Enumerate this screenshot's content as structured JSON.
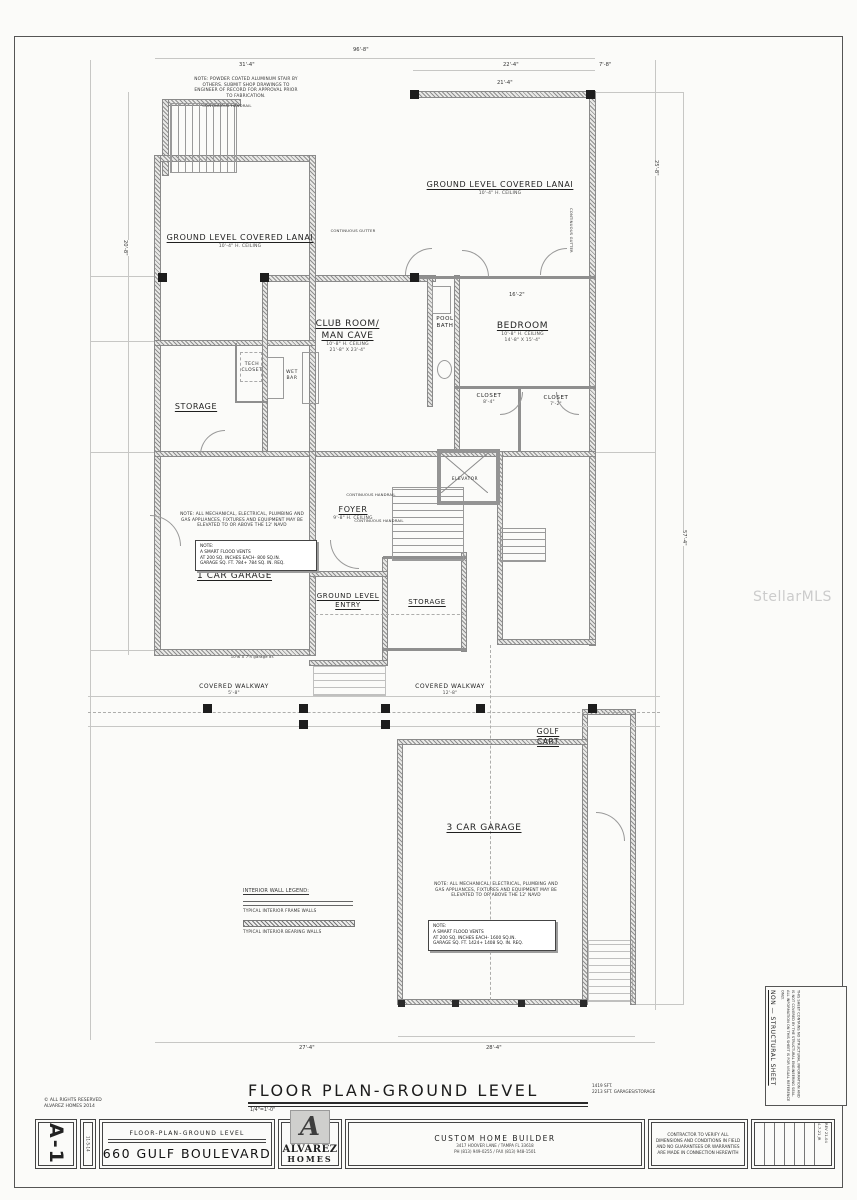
{
  "watermark": "StellarMLS",
  "plan_title": {
    "text": "FLOOR PLAN-GROUND LEVEL",
    "area1": "1419 SFT.",
    "area2": "2213 SFT. GARAGES/STORAGE",
    "scale": "1/4\"=1'-0\""
  },
  "copyright": {
    "line1": "© ALL RIGHTS RESERVED",
    "line2": "ALVAREZ HOMES 2014"
  },
  "side_note": {
    "title": "NON  —  STRUCTURAL  SHEET",
    "body": "THIS SHEET CONTAINS NO STRUCTURAL INFORMATION AND IS NOT COVERED BY THE STRUCTURAL ENGINEERING SEAL. ALL INFORMATION ON THIS SHEET IS FOR VISUAL REFERENCE ONLY."
  },
  "titleblock": {
    "sheet": "A-1",
    "date": "11-5-14",
    "sheet_title": "FLOOR-PLAN-GROUND LEVEL",
    "address": "660 GULF BOULEVARD",
    "logo_letter": "A",
    "brand_line1": "ALVAREZ",
    "brand_line2": "HOMES",
    "builder_title": "CUSTOM HOME BUILDER",
    "builder_line1": "3417 HOOVER LANE / TAMPA FL 33618",
    "builder_line2": "PH (813) 949-0255 / FAX (813) 948-1501",
    "disclaimer": "CONTRACTOR TO VERIFY ALL DIMENSIONS AND CONDITIONS IN FIELD AND NO GUARANTEES OR WARRANTIES ARE MADE IN CONNECTION HEREWITH",
    "rev1": "4-7-21 JR",
    "rev2": "REV 21-04"
  },
  "rooms": {
    "lanai_left": {
      "label": "GROUND LEVEL COVERED LANAI",
      "sub": "10'-4\" H. CEILING"
    },
    "lanai_right": {
      "label": "GROUND LEVEL COVERED LANAI",
      "sub": "10'-4\" H. CEILING"
    },
    "club": {
      "label": "CLUB ROOM/",
      "label2": "MAN CAVE",
      "sub1": "10'-8\" H. CEILING",
      "sub2": "21'-8\" X 23'-4\""
    },
    "pool_bath": {
      "label": "POOL",
      "label2": "BATH"
    },
    "bedroom": {
      "label": "BEDROOM",
      "sub1": "10'-8\" H. CEILING",
      "sub2": "14'-8\" X 15'-4\""
    },
    "tech": {
      "label": "TECH",
      "label2": "CLOSET"
    },
    "wet_bar": {
      "label": "WET",
      "label2": "BAR"
    },
    "storage_upper": {
      "label": "STORAGE"
    },
    "closet1": {
      "label": "CLOSET",
      "sub": "8'-4\""
    },
    "closet2": {
      "label": "CLOSET",
      "sub": "7'-2\""
    },
    "elevator": {
      "label": "ELEVATOR"
    },
    "foyer": {
      "label": "FOYER",
      "sub": "9'-8\" H. CEILING"
    },
    "garage1": {
      "label": "1 CAR GARAGE"
    },
    "entry": {
      "label": "GROUND LEVEL",
      "label2": "ENTRY"
    },
    "storage_mid": {
      "label": "STORAGE"
    },
    "walkway_left": {
      "label": "COVERED WALKWAY",
      "sub": "5'-8\""
    },
    "walkway_right": {
      "label": "COVERED WALKWAY",
      "sub": "12'-8\""
    },
    "golf": {
      "label": "GOLF",
      "label2": "CART"
    },
    "garage3": {
      "label": "3 CAR GARAGE"
    }
  },
  "notes": {
    "stair": "NOTE: POWDER COATED ALUMINUM STAIR BY OTHERS. SUBMIT SHOP DRAWINGS TO ENGINEER OF RECORD FOR APPROVAL PRIOR TO FABRICATION.",
    "mech": "NOTE: ALL MECHANICAL, ELECTRICAL, PLUMBING AND GAS APPLIANCES, FIXTURES AND EQUIPMENT MAY BE ELEVATED TO OR ABOVE THE 12' NAVD",
    "flood_t": "NOTE:",
    "flood1_l1": "A SMART FLOOD VENTS",
    "flood1_l2": "AT 200 SQ. INCHES EACH- 800 SQ.IN.",
    "flood1_l3": "GARAGE SQ. FT. 784+ 784 SQ. IN. REQ.",
    "flood3_l1": "A SMART FLOOD VENTS",
    "flood3_l2": "AT 200 SQ. INCHES EACH- 1600 SQ.IN.",
    "flood3_l3": "GARAGE SQ. FT. 1424+ 1408 SQ. IN. REQ.",
    "handrail": "CONTINUOUS HANDRAIL",
    "gutter": "CONTINUOUS GUTTER",
    "garage_door": "10'w X 7'h garage dr."
  },
  "legend": {
    "title": "INTERIOR WALL LEGEND:",
    "frame": "TYPICAL INTERIOR FRAME WALLS",
    "bearing": "TYPICAL INTERIOR BEARING WALLS"
  },
  "dims": [
    "96'-8\"",
    "31'-4\"",
    "22'-4\"",
    "7'-8\"",
    "21'-4\"",
    "16'-2\"",
    "25'-8\"",
    "57'-4\"",
    "20'-8\"",
    "27'-4\"",
    "28'-4\""
  ]
}
